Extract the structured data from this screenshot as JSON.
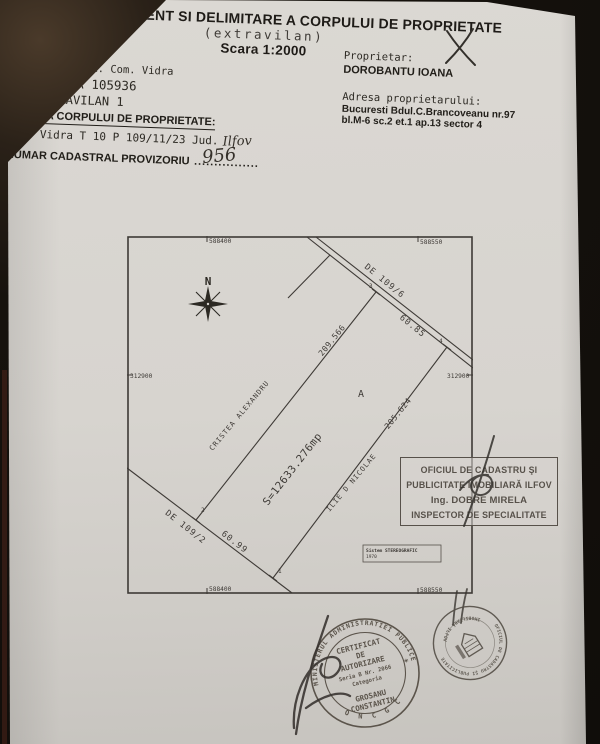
{
  "document": {
    "title": "DE AMPLASAMENT SI DELIMITARE A CORPULUI DE PROPRIETATE",
    "subtitle": "(extravilan)",
    "scale_label": "Scara 1:2000"
  },
  "property_info": {
    "county": "JUDETUL ILFOV",
    "territory": "Teritoriul adm. Com. Vidra",
    "siruta": "COD SIRUTA 105936",
    "extravilan_code": "COD EXTRAVILAN 1",
    "address_heading": "ADRESA CORPULUI DE PROPRIETATE:",
    "address_line": "Com. Vidra T 10 P 109/11/23 Jud.",
    "address_handwritten": "Ilfov",
    "cadastral_heading": "NUMAR CADASTRAL PROVIZORIU",
    "cadastral_dots": "................",
    "cadastral_number_handwritten": "956"
  },
  "owner_info": {
    "owner_heading": "Proprietar:",
    "owner_name": "DOROBANTU IOANA",
    "address_heading": "Adresa proprietarului:",
    "address_line1": "Bucuresti Bdul.C.Brancoveanu nr.97",
    "address_line2": "bl.M-6 sc.2 et.1 ap.13 sector 4"
  },
  "plan": {
    "north_label": "N",
    "parcel_letter": "A",
    "area_label": "S=12633.276mp",
    "coordinates": {
      "top_left": "588400",
      "top_right": "588550",
      "bottom_left": "588400",
      "bottom_right": "588550",
      "left": "312900",
      "right": "312900"
    },
    "roads": {
      "north_east": "DE 109/6",
      "south_west": "DE 109/2"
    },
    "side_lengths": {
      "north_east": "60.85",
      "south_west": "60.99",
      "north_west": "209.566",
      "south_east": "205.624"
    },
    "neighbors": {
      "north_west": "CRISTEA ALEXANDRU",
      "south_east": "ILIE D NICOLAE"
    },
    "vertices": [
      "1",
      "2",
      "3",
      "4"
    ],
    "legend_line1": "Sistem STEREOGRAFIC",
    "legend_line2": "1970"
  },
  "ocpi_box": {
    "line1": "OFICIUL DE CADASTRU ŞI",
    "line2": "PUBLICITATE IMOBILIARĂ ILFOV",
    "line3": "Ing. DOBRE MIRELA",
    "line4": "INSPECTOR DE SPECIALITATE"
  },
  "stamps": {
    "certificate_stamp": {
      "ring_top": "MINISTERUL ADMINISTRATIEI PUBLICE",
      "ring_bottom": "O N C G C",
      "line1": "CERTIFICAT",
      "line2": "DE",
      "line3": "AUTORIZARE",
      "line4": "Seria B Nr. 2066",
      "line5": "Categoria",
      "line6": "GROSANU",
      "line7": "CONSTANTIN"
    },
    "ocpi_round_stamp": {
      "ring_top": "OFICIUL DE CADASTRU ŞI PUBLICITATE",
      "ring_bottom": "IMOBILIARĂ ILFOV"
    }
  },
  "annotations": {
    "check_mark": "X"
  },
  "colors": {
    "paper": "#d7d4cf",
    "ink": "#28251f",
    "plan_line": "#3e3a36",
    "stamp_ink": "#5b544b",
    "background": "#16120d"
  }
}
